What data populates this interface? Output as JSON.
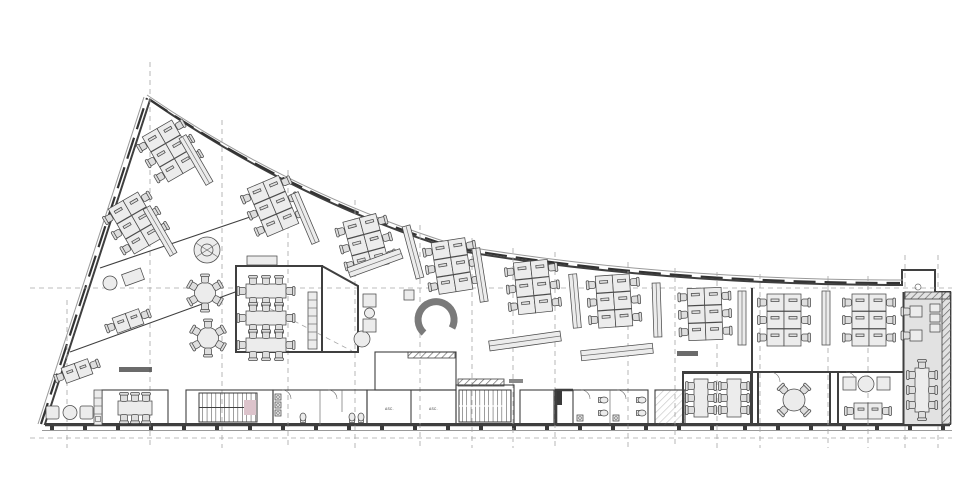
{
  "document": {
    "type": "architectural floor plan",
    "view": "office level plan, curved wedge building"
  },
  "labels": {
    "elevator_left": "ASC.",
    "elevator_right": "ASC."
  },
  "colors": {
    "background": "#ffffff",
    "floor": "#cdcdcd",
    "room_light": "#e7e7e7",
    "annex": "#e2e2e2",
    "pink": "#dcc3cb",
    "blue": "#a0c5da",
    "wall": "#3f3f3f",
    "line_thin": "#6e6e6e",
    "grid": "#a6a6a6",
    "furniture_fill": "#dedede",
    "mark_dark": "#3a3a3a"
  },
  "rooms": [
    {
      "name": "open-office-west",
      "kind": "open office",
      "fill": "floor"
    },
    {
      "name": "open-office-center",
      "kind": "open office",
      "fill": "floor"
    },
    {
      "name": "open-office-east",
      "kind": "open office",
      "fill": "floor"
    },
    {
      "name": "conference-room-center",
      "kind": "conference room",
      "fill": "room_light"
    },
    {
      "name": "meeting-room-west",
      "kind": "meeting room",
      "fill": "room_light"
    },
    {
      "name": "meeting-room-southeast",
      "kind": "meeting room",
      "fill": "room_light"
    },
    {
      "name": "round-table-room",
      "kind": "meeting room",
      "fill": "floor"
    },
    {
      "name": "storage-room-east",
      "kind": "utility room",
      "fill": "floor"
    },
    {
      "name": "stair-core-west",
      "kind": "stairwell",
      "fill": "pink"
    },
    {
      "name": "stair-core-center",
      "kind": "stairwell",
      "fill": "pink"
    },
    {
      "name": "wc-west",
      "kind": "toilets",
      "fill": "blue"
    },
    {
      "name": "wc-center",
      "kind": "toilets",
      "fill": "blue"
    },
    {
      "name": "elevator-rooms",
      "kind": "elevators",
      "fill": "pink"
    },
    {
      "name": "service-room-center",
      "kind": "service room",
      "fill": "pink"
    },
    {
      "name": "lounge-southwest",
      "kind": "lounge",
      "fill": "floor"
    },
    {
      "name": "annex-east",
      "kind": "existing building annex",
      "fill": "annex"
    },
    {
      "name": "vestibule-northeast",
      "kind": "entrance vestibule",
      "fill": "floor"
    }
  ],
  "furniture": {
    "desk_clusters_6": 10,
    "office_desk_pairs": 3,
    "round_tables_6_chairs": 2,
    "round_table_4_chairs": 1,
    "conference_tables_8_chairs": 3,
    "meeting_tables_6_chairs": 3,
    "annex_table_8_chairs": 1,
    "shelving_units": 9,
    "lounge_set": "2 armchairs + round table"
  }
}
